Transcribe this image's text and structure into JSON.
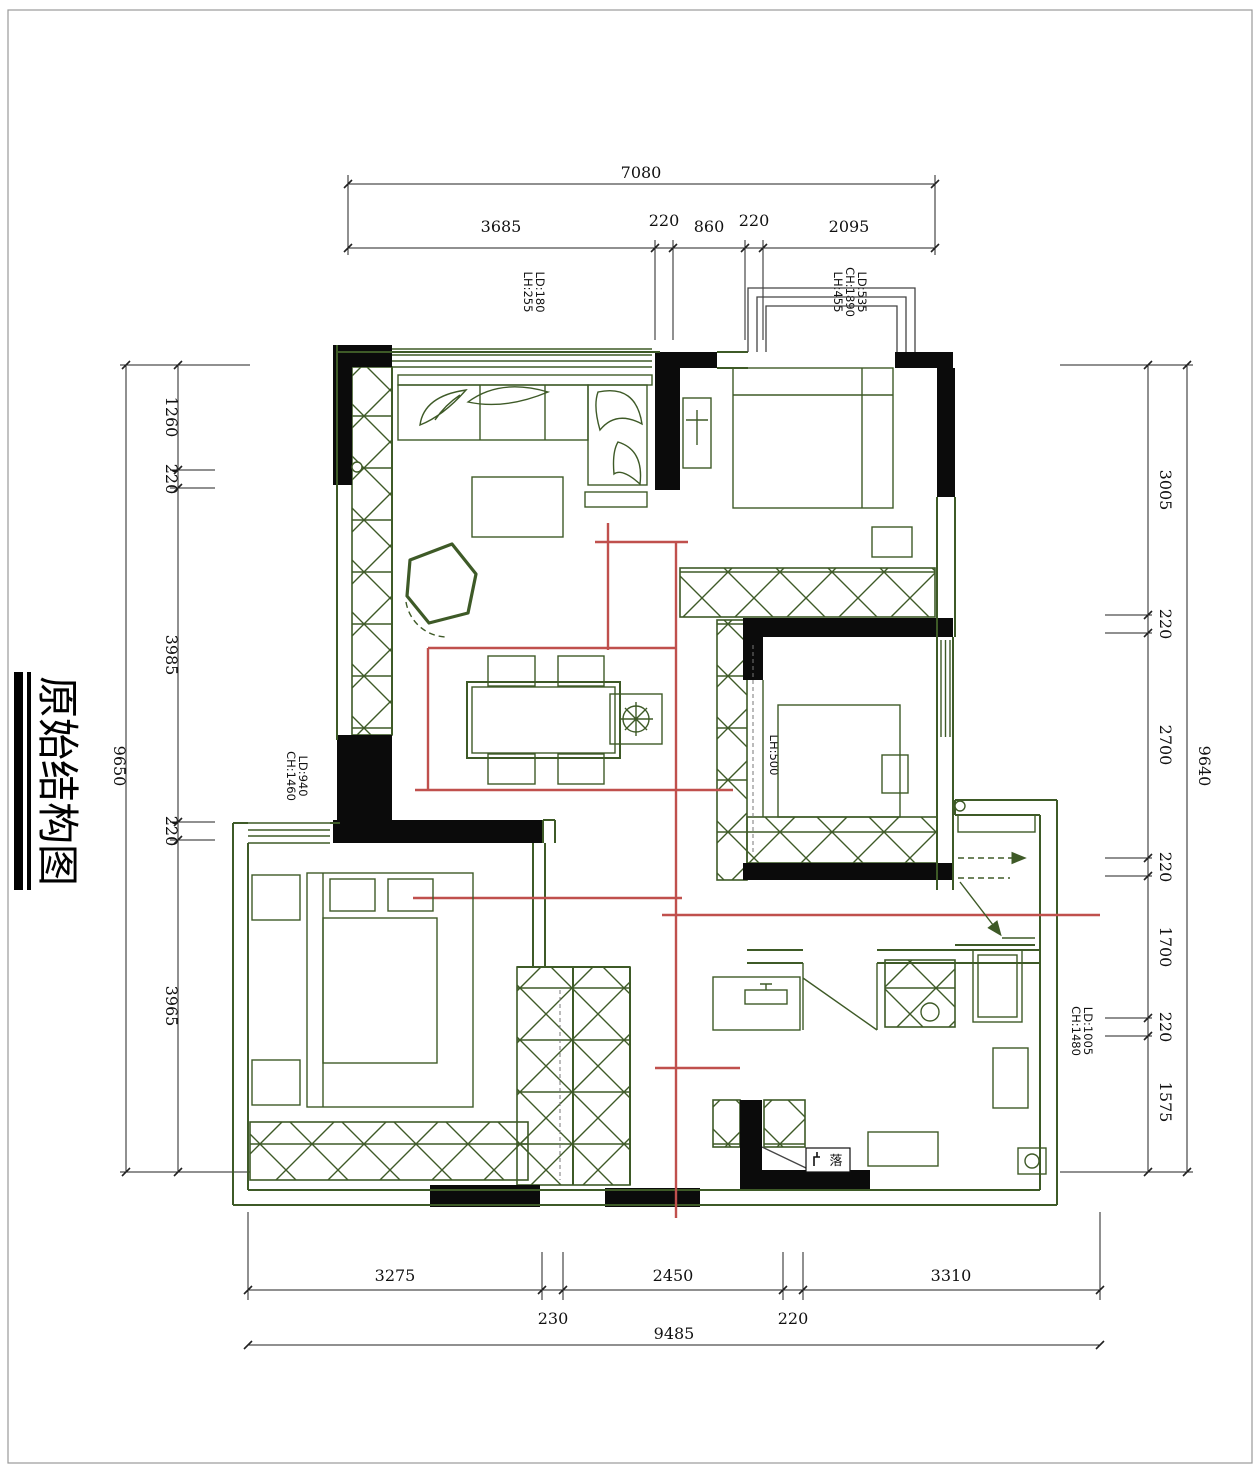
{
  "title": "原始结构图",
  "colors": {
    "wall_green": "#3e5a27",
    "beam_red": "#c0504d",
    "wall_black": "#0b0b0b"
  },
  "dimensions": {
    "top": {
      "overall": "7080",
      "segments": [
        "3685",
        "220",
        "860",
        "220",
        "2095"
      ]
    },
    "left": {
      "overall": "9650",
      "segments": [
        "1260",
        "220",
        "3985",
        "220",
        "3965"
      ]
    },
    "right": {
      "overall": "9640",
      "segments": [
        "3005",
        "220",
        "2700",
        "220",
        "1700",
        "220",
        "1575"
      ]
    },
    "bottom": {
      "overall": "9485",
      "segments": [
        "3275",
        "2450",
        "3310"
      ],
      "sub_segments": [
        "230",
        "220"
      ]
    }
  },
  "labels": {
    "window_top_left": [
      "LD:180",
      "LH:255"
    ],
    "window_bay": [
      "LD:535",
      "CH:1890",
      "LH:455"
    ],
    "window_left": [
      "LD:940",
      "CH:1460"
    ],
    "opening_mid": [
      "LH:500"
    ],
    "window_right": [
      "LD:1005",
      "CH:1480"
    ],
    "drain": "落"
  }
}
